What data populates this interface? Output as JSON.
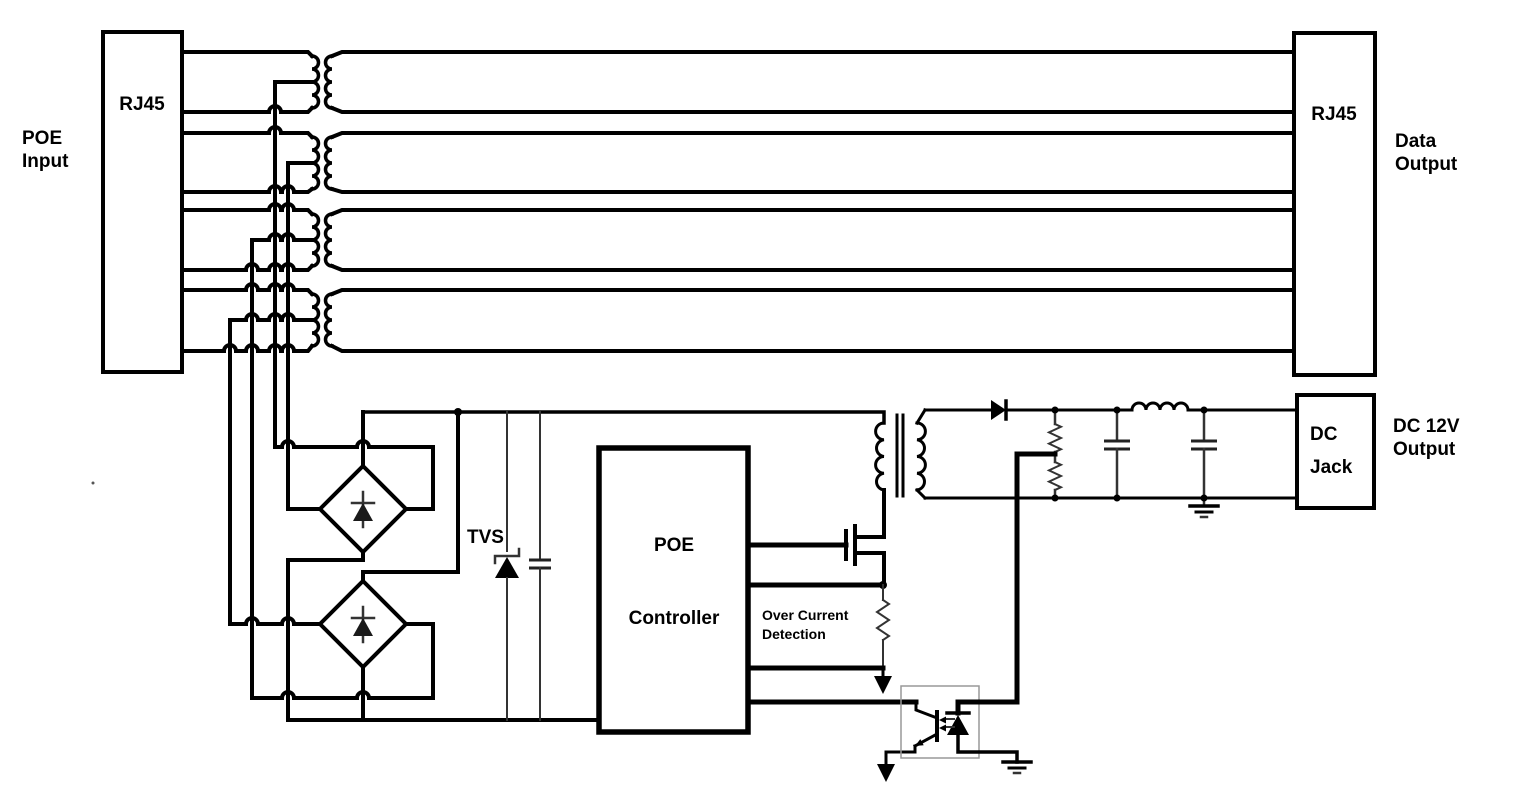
{
  "labels": {
    "poe_input_line1": "POE",
    "poe_input_line2": "Input",
    "rj45_left": "RJ45",
    "rj45_right": "RJ45",
    "data_output_line1": "Data",
    "data_output_line2": "Output",
    "tvs": "TVS",
    "controller_line1": "POE",
    "controller_line2": "Controller",
    "over_current_line1": "Over Current",
    "over_current_line2": "Detection",
    "dc_jack_line1": "DC",
    "dc_jack_line2": "Jack",
    "dc_output_line1": "DC 12V",
    "dc_output_line2": "Output"
  },
  "colors": {
    "background": "#ffffff",
    "line": "#000000",
    "thin_line": "#333333",
    "optocoupler_box": "#999999"
  },
  "components": [
    "rj45-connector-input",
    "ethernet-isolation-transformers-x4",
    "rj45-connector-data-output",
    "diode-bridge-rectifier-1",
    "diode-bridge-rectifier-2",
    "tvs-protection-diode",
    "input-filter-capacitor",
    "poe-controller-ic",
    "switching-mosfet",
    "over-current-sense-resistor",
    "flyback-transformer",
    "output-rectifier-diode",
    "feedback-voltage-divider",
    "output-filter-capacitors-x2",
    "output-filter-inductor",
    "optocoupler-feedback",
    "dc-jack-connector",
    "ground-symbols"
  ]
}
